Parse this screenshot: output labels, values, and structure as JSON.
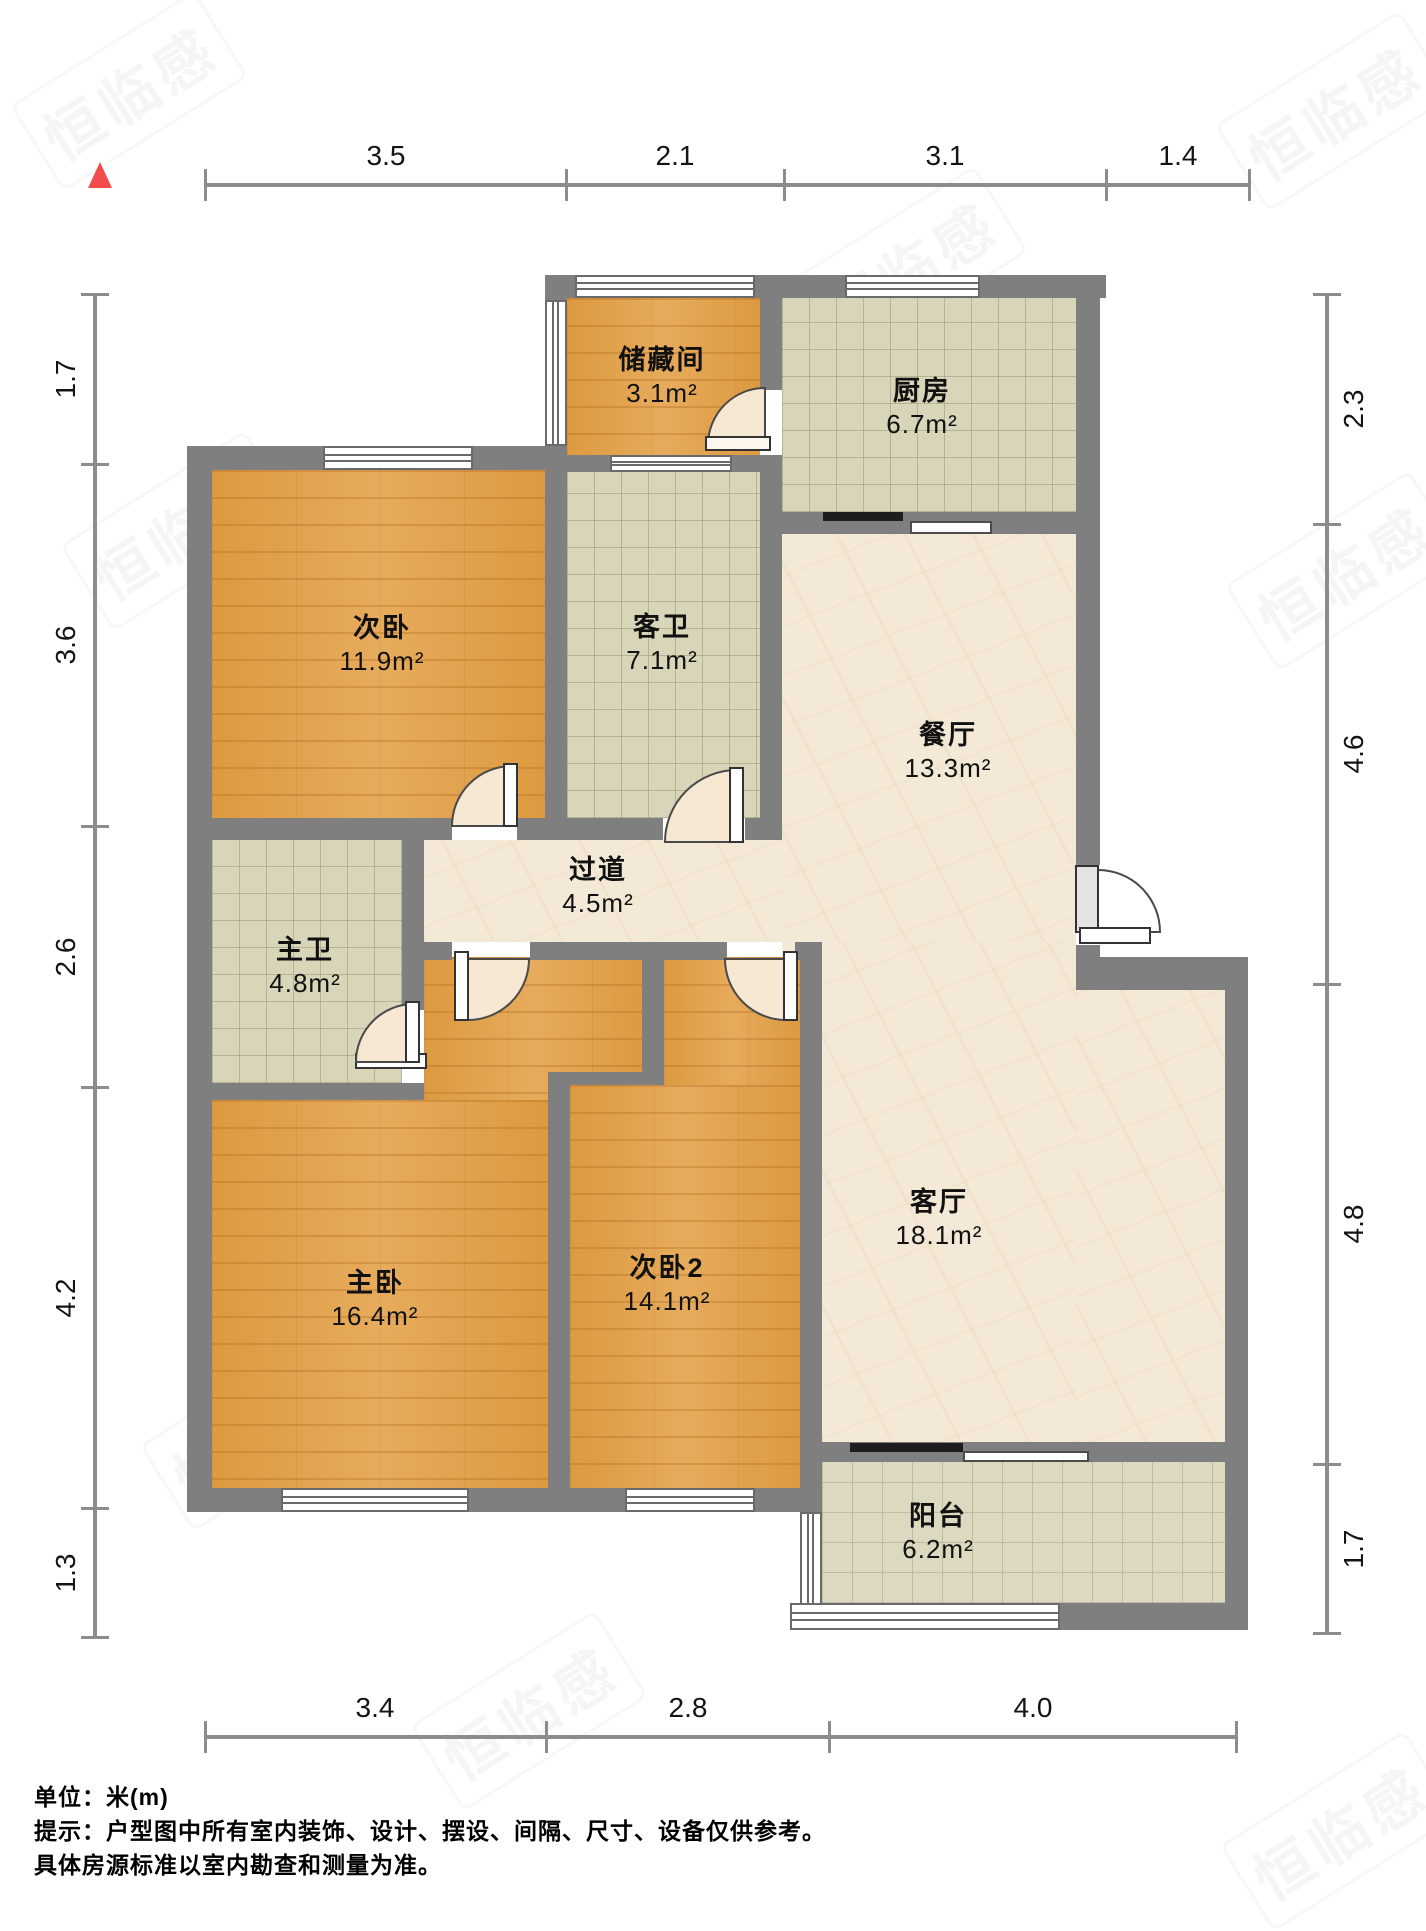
{
  "rooms": [
    {
      "name": "储藏间",
      "area": "3.1m²"
    },
    {
      "name": "厨房",
      "area": "6.7m²"
    },
    {
      "name": "次卧",
      "area": "11.9m²"
    },
    {
      "name": "客卫",
      "area": "7.1m²"
    },
    {
      "name": "餐厅",
      "area": "13.3m²"
    },
    {
      "name": "过道",
      "area": "4.5m²"
    },
    {
      "name": "主卫",
      "area": "4.8m²"
    },
    {
      "name": "主卧",
      "area": "16.4m²"
    },
    {
      "name": "次卧2",
      "area": "14.1m²"
    },
    {
      "name": "客厅",
      "area": "18.1m²"
    },
    {
      "name": "阳台",
      "area": "6.2m²"
    }
  ],
  "dimensions": {
    "top": [
      "3.5",
      "2.1",
      "3.1",
      "1.4"
    ],
    "left": [
      "1.7",
      "3.6",
      "2.6",
      "4.2",
      "1.3"
    ],
    "right": [
      "2.3",
      "4.6",
      "4.8",
      "1.7"
    ],
    "bottom": [
      "3.4",
      "2.8",
      "4.0"
    ]
  },
  "footer": {
    "unit": "单位：米(m)",
    "hint1": "提示：户型图中所有室内装饰、设计、摆设、间隔、尺寸、设备仅供参考。",
    "hint2": "具体房源标准以室内勘查和测量为准。"
  },
  "watermark": {
    "text": "恒临感"
  },
  "colors": {
    "wall": "#7f7f7f",
    "wood": "#e0a14c",
    "tile": "#d8d5b9",
    "marble": "#f3e9d6",
    "compass": "#f24c4c"
  }
}
